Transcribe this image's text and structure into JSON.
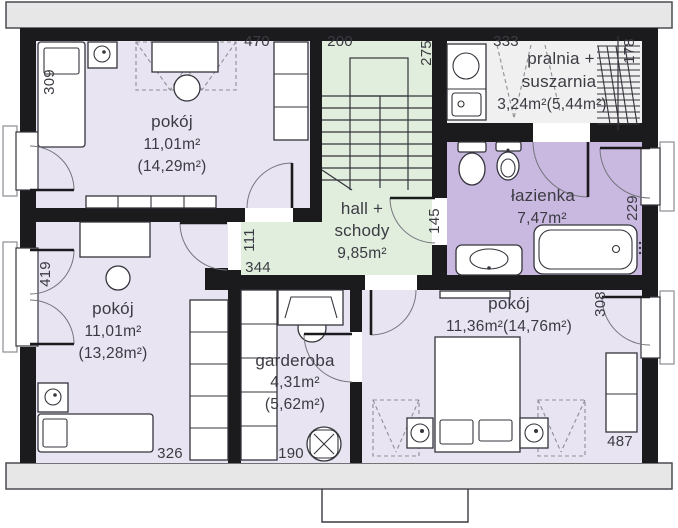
{
  "plan_title": "attic floor plan",
  "colors": {
    "wall": "#1b1b1e",
    "room_fill": "#e8e4f1",
    "hall_fill": "#e2eedd",
    "bath_fill": "#c9b8df",
    "laundry_fill": "#f0f0f0",
    "eave_fill": "#e7e7e7",
    "line": "#34343c",
    "dash": "#8e8e96",
    "text": "#3b3b43"
  },
  "rooms": {
    "room_top_left": {
      "name": "pokój",
      "area": "11,01m²",
      "area_total": "(14,29m²)"
    },
    "hall": {
      "name_line1": "hall +",
      "name_line2": "schody",
      "area": "9,85m²"
    },
    "laundry": {
      "name_line1": "pralnia +",
      "name_line2": "suszarnia",
      "area": "3,24m²(5,44m²)"
    },
    "bathroom": {
      "name": "łazienka",
      "area": "7,47m²"
    },
    "room_bottom_left": {
      "name": "pokój",
      "area": "11,01m²",
      "area_total": "(13,28m²)"
    },
    "garderoba": {
      "name": "garderoba",
      "area": "4,31m²",
      "area_total": "(5,62m²)"
    },
    "bedroom": {
      "name": "pokój",
      "area": "11,36m²(14,76m²)"
    }
  },
  "dims": {
    "d309": "309",
    "d470": "470",
    "d200": "200",
    "d275": "275",
    "d111": "111",
    "d344": "344",
    "d145": "145",
    "d333": "333",
    "d178": "178",
    "d229": "229",
    "d419": "419",
    "d326": "326",
    "d190": "190",
    "d308": "308",
    "d487": "487"
  }
}
